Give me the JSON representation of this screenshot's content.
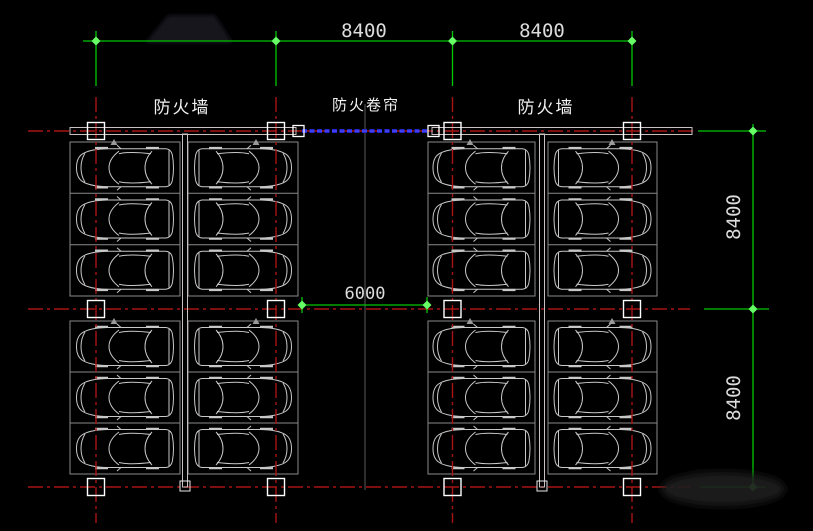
{
  "labels": {
    "firewall_left": "防火墙",
    "fire_shutter": "防火卷帘",
    "firewall_right": "防火墙"
  },
  "dimensions": {
    "top_bay_left": "8400",
    "top_bay_right": "8400",
    "center_aisle": "6000",
    "right_bay_upper": "8400",
    "right_bay_lower": "8400"
  },
  "colors": {
    "background": "#000000",
    "grid_line_red": "#a81414",
    "dimension_green": "#00c800",
    "tick_green": "#66ff66",
    "shutter_blue": "#2525cc",
    "wall_white": "#c9c0c0",
    "stall_gray": "#8a8a8a",
    "car_gray": "#c8c8c8",
    "column_marker_white": "#ffffff",
    "label_text": "#f2f2f2",
    "dimension_text": "#dcdcdc"
  }
}
